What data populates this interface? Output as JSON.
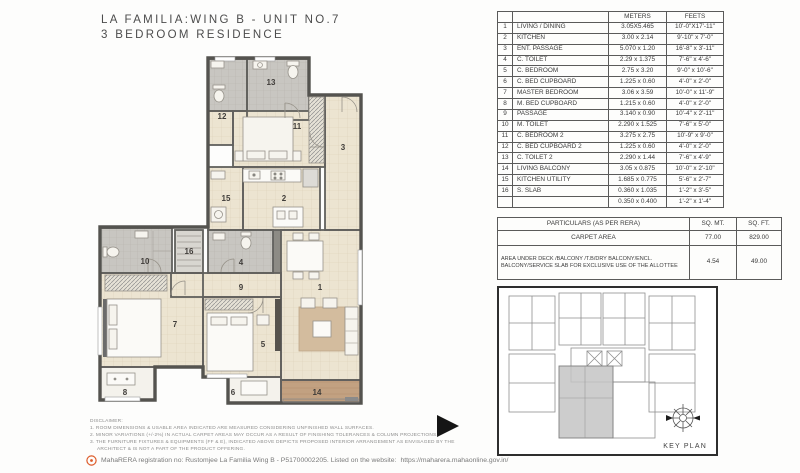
{
  "title": {
    "line1": "LA FAMILIA:WING B - UNIT NO.7",
    "line2": "3 BEDROOM RESIDENCE"
  },
  "dimensions_table": {
    "headers": {
      "meters": "METERS",
      "feets": "FEETS"
    },
    "rows": [
      {
        "no": "1",
        "name": "LIVING / DINING",
        "meters": "3.05X5.465",
        "feets": "10'-0\"X17'-11\""
      },
      {
        "no": "2",
        "name": "KITCHEN",
        "meters": "3.00 x 2.14",
        "feets": "9'-10\" x 7'-0\""
      },
      {
        "no": "3",
        "name": "ENT. PASSAGE",
        "meters": "5.070 x 1.20",
        "feets": "16'-8\" x 3'-11\""
      },
      {
        "no": "4",
        "name": "C. TOILET",
        "meters": "2.29 x 1.375",
        "feets": "7'-6\" x 4'-6\""
      },
      {
        "no": "5",
        "name": "C. BEDROOM",
        "meters": "2.75 x 3.20",
        "feets": "9'-0\" x 10'-6\""
      },
      {
        "no": "6",
        "name": "C. BED CUPBOARD",
        "meters": "1.225 x 0.60",
        "feets": "4'-0\" x 2'-0\""
      },
      {
        "no": "7",
        "name": "MASTER BEDROOM",
        "meters": "3.06 x 3.59",
        "feets": "10'-0\" x 11'-9\""
      },
      {
        "no": "8",
        "name": "M. BED CUPBOARD",
        "meters": "1.215 x 0.60",
        "feets": "4'-0\" x 2'-0\""
      },
      {
        "no": "9",
        "name": "PASSAGE",
        "meters": "3.140 x 0.90",
        "feets": "10'-4\" x 2'-11\""
      },
      {
        "no": "10",
        "name": "M. TOILET",
        "meters": "2.290 x 1.525",
        "feets": "7'-6\" x 5'-0\""
      },
      {
        "no": "11",
        "name": "C. BEDROOM 2",
        "meters": "3.275 x 2.75",
        "feets": "10'-9\" x 9'-0\""
      },
      {
        "no": "12",
        "name": "C. BED CUPBOARD 2",
        "meters": "1.225 x 0.60",
        "feets": "4'-0\" x 2'-0\""
      },
      {
        "no": "13",
        "name": "C. TOILET 2",
        "meters": "2.290 x 1.44",
        "feets": "7'-6\" x 4'-9\""
      },
      {
        "no": "14",
        "name": "LIVING BALCONY",
        "meters": "3.05 x 0.875",
        "feets": "10'-0\" x 2'-10\""
      },
      {
        "no": "15",
        "name": "KITCHEN UTILITY",
        "meters": "1.685 x 0.775",
        "feets": "5'-6\" x 2'-7\""
      },
      {
        "no": "16",
        "name": "S. SLAB",
        "meters": "0.360 x 1.035",
        "feets": "1'-2\" x 3'-5\""
      },
      {
        "no": "",
        "name": "",
        "meters": "0.350 x 0.400",
        "feets": "1'-2\" x 1'-4\""
      }
    ]
  },
  "particulars_table": {
    "header": {
      "label": "PARTICULARS (AS PER RERA)",
      "sqmt": "SQ. MT.",
      "sqft": "SQ. FT."
    },
    "rows": [
      {
        "label": "CARPET AREA",
        "sqmt": "77.00",
        "sqft": "829.00"
      },
      {
        "label": "AREA UNDER DECK /BALCONY /T.B/DRY BALCONY/ENCL. BALCONY/SERVICE SLAB FOR EXCLUSIVE USE OF THE ALLOTTEE",
        "sqmt": "4.54",
        "sqft": "49.00"
      }
    ]
  },
  "key_plan": {
    "label": "KEY PLAN"
  },
  "plan": {
    "room_numbers": [
      "1",
      "2",
      "3",
      "4",
      "5",
      "6",
      "7",
      "8",
      "9",
      "10",
      "11",
      "12",
      "13",
      "14",
      "15",
      "16"
    ]
  },
  "disclaimer": {
    "heading": "DISCLAIMER:",
    "line1": "1. ROOM DIMENSIONS & USABLE AREA INDICATED ARE MEASURED CONSIDERING UNFINISHED WALL SURFACES.",
    "line2": "2. MINOR VARIATIONS (+/-2%) IN ACTUAL CARPET AREAS MAY OCCUR AS A RESULT OF FINISHING TOLERANCES & COLUMN PROJECTIONS.",
    "line3": "3. THE FURNITURE FIXTURES & EQUIPMENTS (FF & E), INDICATED ABOVE DEPICTS PROPOSED INTERIOR ARRANGEMENT AS ENVISAGED BY THE",
    "line4": "ARCHITECT & IS NOT A PART OF THE PRODUCT OFFERING."
  },
  "footer": {
    "prefix": "MahaRERA registration no:  Rustomjee La Familia Wing B - P51700002205. Listed on the website: ",
    "url": "https://maharera.mahaonline.gov.in/"
  }
}
